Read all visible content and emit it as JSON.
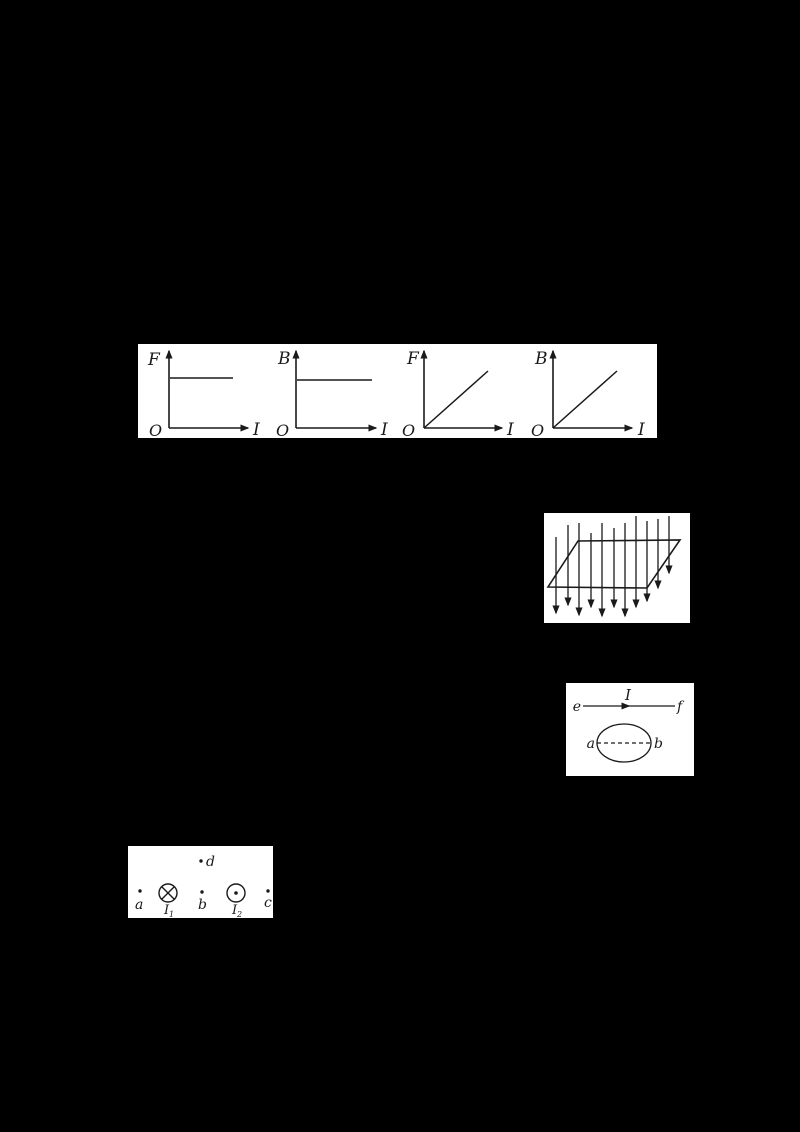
{
  "colors": {
    "background": "#000000",
    "panel": "#ffffff",
    "ink": "#1a1a1a"
  },
  "graphs_panel": {
    "description": "four graphs of F or B versus I",
    "graphs": [
      {
        "y_label": "F",
        "x_label": "I",
        "origin_label": "O",
        "curve": "constant-horizontal"
      },
      {
        "y_label": "B",
        "x_label": "I",
        "origin_label": "O",
        "curve": "constant-horizontal"
      },
      {
        "y_label": "F",
        "x_label": "I",
        "origin_label": "O",
        "curve": "proportional-diagonal"
      },
      {
        "y_label": "B",
        "x_label": "I",
        "origin_label": "O",
        "curve": "proportional-diagonal"
      }
    ]
  },
  "field_plane_panel": {
    "description": "uniform field lines pointing downward through an inclined parallelogram plane",
    "field_direction": "down"
  },
  "wire_loop_panel": {
    "wire_left_label": "e",
    "wire_right_label": "f",
    "current_label": "I",
    "loop_left_label": "a",
    "loop_right_label": "b"
  },
  "currents_panel": {
    "point_d_label": "d",
    "point_a_label": "a",
    "point_b_label": "b",
    "point_c_label": "c",
    "wire1": {
      "label": "I",
      "sub": "1",
      "direction": "into-page"
    },
    "wire2": {
      "label": "I",
      "sub": "2",
      "direction": "out-of-page"
    }
  }
}
